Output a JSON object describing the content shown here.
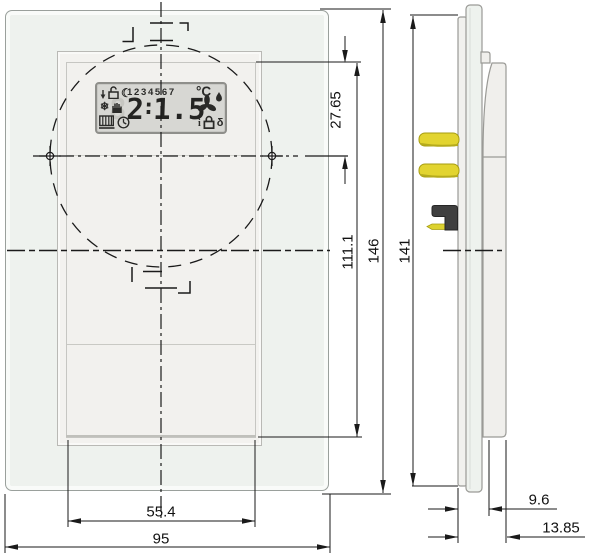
{
  "drawing_type": "dimensional-drawing-room-thermostat",
  "views": {
    "front": "front-view-glass-panel",
    "side": "side-view-with-bus-connector"
  },
  "display": {
    "days": "1234567",
    "unit": "°C",
    "ghost_digit": "8",
    "digit_left": "2",
    "colon": ":",
    "digit_right": "1.5",
    "value_shown": "21.5",
    "icon_glyphs": {
      "moon": "☾",
      "snowflake": "❄",
      "info": "i",
      "key": "δ"
    },
    "icons": [
      "arrow-icon",
      "open-lock-icon",
      "moon-icon",
      "snowflake-icon",
      "hand-icon",
      "radiator-icon",
      "clock-icon",
      "fan-icon",
      "droplet-icon",
      "info-icon",
      "lock-icon",
      "key-icon"
    ]
  },
  "dimensions": {
    "lcd_top_to_center": "27.65",
    "sensor_area_height": "111.1",
    "glass_height": "146",
    "unit_height": "141",
    "sensor_area_width": "55.4",
    "glass_width": "95",
    "depth_front": "9.6",
    "depth_total": "13.85"
  },
  "colors": {
    "glass_fill": "#eef2ee",
    "frame_fill": "#f3f2ef",
    "lcd_fill": "#d7d7d3",
    "pin_yellow": "#e2d430",
    "connector_dark": "#3f3f3f",
    "line": "#1a1a1a"
  }
}
